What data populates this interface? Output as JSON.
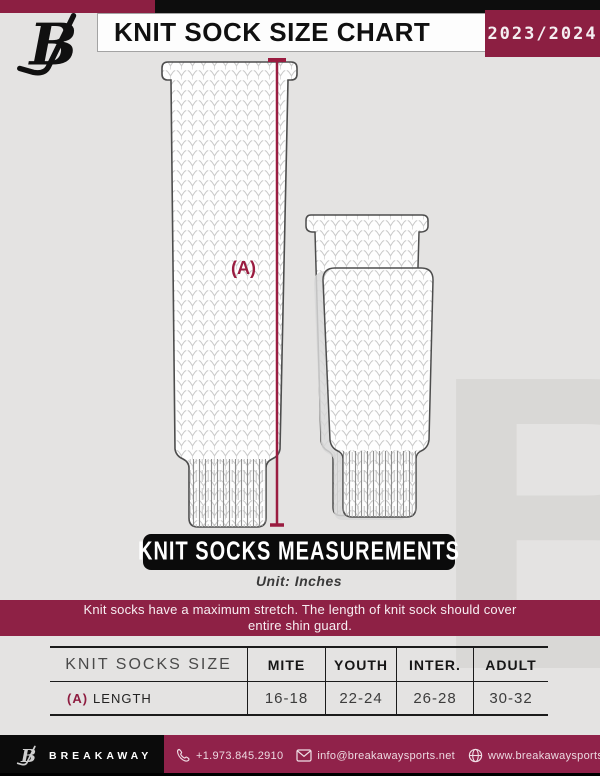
{
  "colors": {
    "maroon": "#8C1F42",
    "notice_maroon": "#8E2145",
    "footer_maroon": "#90224A",
    "black": "#0D0D0D",
    "background": "#E4E3E2",
    "measure_line": "#9A1C40"
  },
  "header": {
    "title": "KNIT SOCK SIZE CHART",
    "season": "2023/2024",
    "brand_initial": "B"
  },
  "diagram": {
    "dimension_label": "(A)",
    "banner_title": "KNIT SOCKS MEASUREMENTS",
    "unit_note": "Unit: Inches"
  },
  "notice": "Knit socks have a maximum stretch. The length of knit sock should cover entire shin guard.",
  "size_table": {
    "columns": [
      "KNIT SOCKS SIZE",
      "MITE",
      "YOUTH",
      "INTER.",
      "ADULT"
    ],
    "rows": [
      {
        "label_prefix": "(A)",
        "label": "LENGTH",
        "values": [
          "16-18",
          "22-24",
          "26-28",
          "30-32"
        ]
      }
    ]
  },
  "footer": {
    "brand": "BREAKAWAY",
    "phone": "+1.973.845.2910",
    "email": "info@breakawaysports.net",
    "website": "www.breakawaysports.net"
  },
  "watermark_letter": "B"
}
